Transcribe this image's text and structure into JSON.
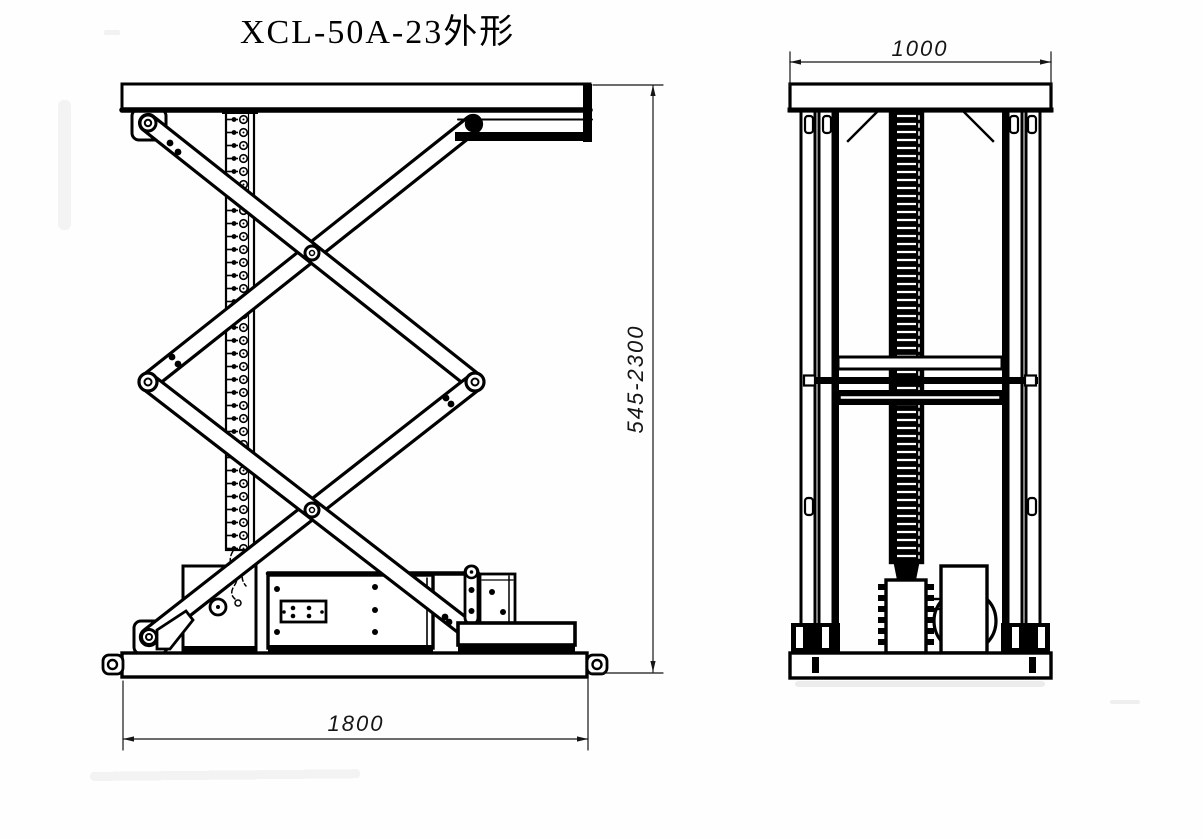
{
  "title": "XCL-50A-23外形",
  "drawing": {
    "side_view": {
      "width_dim": "1800",
      "height_dim": "545-2300"
    },
    "front_view": {
      "width_dim": "1000"
    }
  },
  "colors": {
    "ink": "#000000",
    "paper": "#ffffff"
  }
}
